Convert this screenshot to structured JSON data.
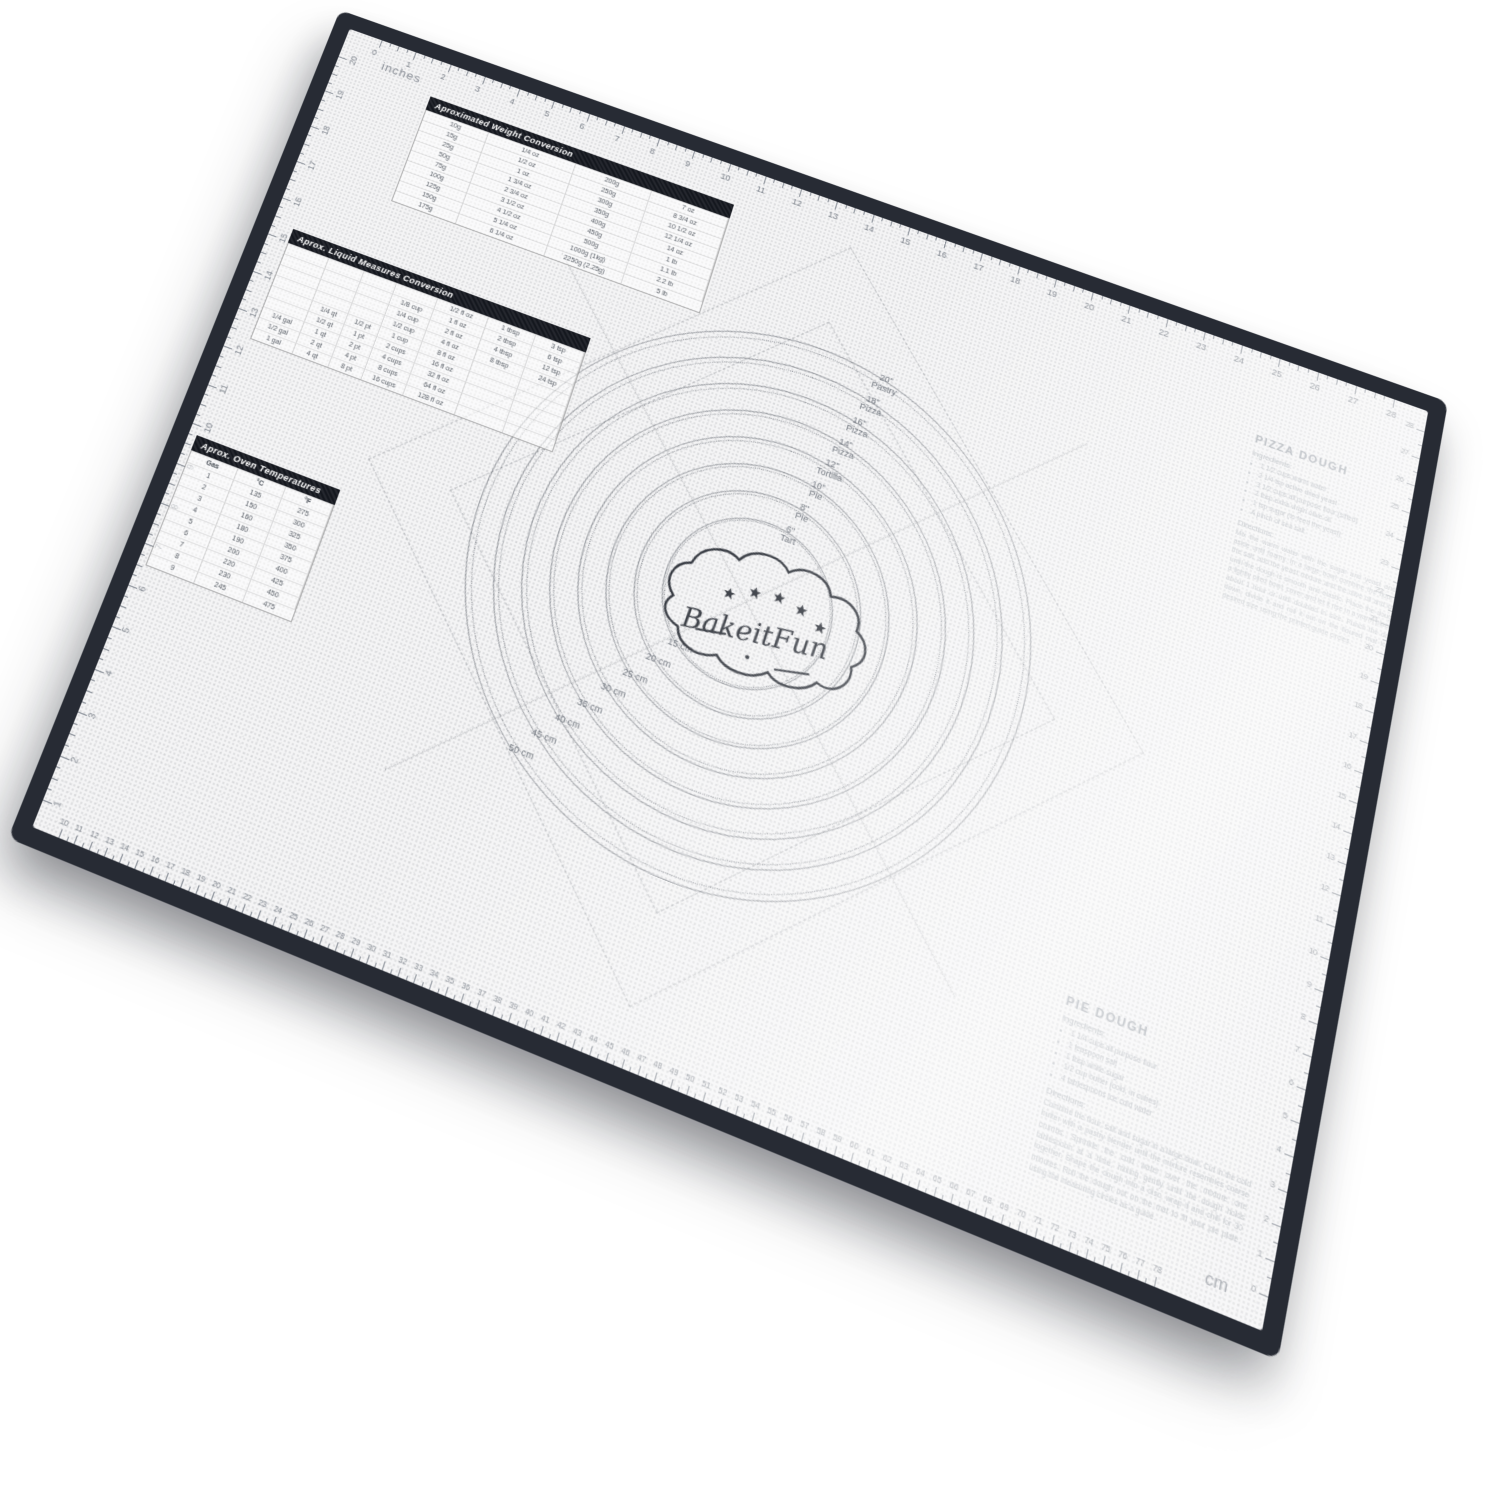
{
  "mat": {
    "brand": "BakeitFun",
    "border_color": "#272b34",
    "surface_color": "#f4f4f5",
    "unit_label_top": "inches",
    "unit_label_bottom": "cm",
    "rulers": {
      "top_inches": {
        "start": 0,
        "end": 28
      },
      "left_inches": {
        "start": 20,
        "end": 1
      },
      "bottom_cm": {
        "start": 10,
        "end": 78
      },
      "right_cm": {
        "start": 0,
        "end": 28
      }
    },
    "center": {
      "cx": 575,
      "cy": 445
    },
    "inch_circles": [
      {
        "size": "20\"",
        "type": "Pastry",
        "radius": 270
      },
      {
        "size": "18\"",
        "type": "Pizza",
        "radius": 243
      },
      {
        "size": "16\"",
        "type": "Pizza",
        "radius": 216
      },
      {
        "size": "14\"",
        "type": "Pizza",
        "radius": 189
      },
      {
        "size": "12\"",
        "type": "Tortilla",
        "radius": 162
      },
      {
        "size": "10\"",
        "type": "Pie",
        "radius": 135
      },
      {
        "size": "8\"",
        "type": "Pie",
        "radius": 108
      },
      {
        "size": "6\"",
        "type": "Tart",
        "radius": 81
      }
    ],
    "cm_circles": [
      {
        "label": "50 cm",
        "radius": 264
      },
      {
        "label": "45 cm",
        "radius": 238
      },
      {
        "label": "40 cm",
        "radius": 211
      },
      {
        "label": "35 cm",
        "radius": 185
      },
      {
        "label": "30 cm",
        "radius": 158
      },
      {
        "label": "25 cm",
        "radius": 132
      },
      {
        "label": "20 cm",
        "radius": 105
      },
      {
        "label": "15 cm",
        "radius": 79
      }
    ],
    "weight_table": {
      "title": "Aproximated Weight Conversion",
      "rows": [
        [
          "10g",
          "1/4 oz",
          "200g",
          "7 oz"
        ],
        [
          "15g",
          "1/2 oz",
          "250g",
          "8 3/4 oz"
        ],
        [
          "25g",
          "1 oz",
          "300g",
          "10 1/2 oz"
        ],
        [
          "50g",
          "1 3/4 oz",
          "350g",
          "12 1/4 oz"
        ],
        [
          "75g",
          "2 3/4 oz",
          "400g",
          "14 oz"
        ],
        [
          "100g",
          "3 1/2 oz",
          "450g",
          "1 lb"
        ],
        [
          "125g",
          "4 1/2 oz",
          "500g",
          "1.1 lb"
        ],
        [
          "150g",
          "5 1/4 oz",
          "1000g (1kg)",
          "2.2 lb"
        ],
        [
          "175g",
          "6 1/4 oz",
          "2250g (2.25g)",
          "5 lb"
        ]
      ]
    },
    "liquid_table": {
      "title": "Aprox. Liquid Measures Conversion",
      "rows": [
        [
          "",
          "",
          "",
          "",
          "1/2 fl oz",
          "1 tbsp",
          "3 tsp"
        ],
        [
          "",
          "",
          "",
          "1/8 cup",
          "1 fl oz",
          "2 tbsp",
          "6 tsp"
        ],
        [
          "",
          "",
          "",
          "1/4 cup",
          "2 fl oz",
          "4 tbsp",
          "12 tsp"
        ],
        [
          "",
          "",
          "",
          "1/2 cup",
          "4 fl oz",
          "8 tbsp",
          "24 tsp"
        ],
        [
          "",
          "1/4 qt",
          "1/2 pt",
          "1 cup",
          "8 fl oz",
          "",
          ""
        ],
        [
          "",
          "1/2 qt",
          "1 pt",
          "2 cups",
          "16 fl oz",
          "",
          ""
        ],
        [
          "1/4 gal",
          "1 qt",
          "2 pt",
          "4 cups",
          "32 fl oz",
          "",
          ""
        ],
        [
          "1/2 gal",
          "2 qt",
          "4 pt",
          "8 cups",
          "64 fl oz",
          "",
          ""
        ],
        [
          "1 gal",
          "4 qt",
          "8 pt",
          "16 cups",
          "128 fl oz",
          "",
          ""
        ]
      ]
    },
    "oven_table": {
      "title": "Aprox. Oven Temperatures",
      "headers": [
        "Gas",
        "°C",
        "°F"
      ],
      "rows": [
        [
          "1",
          "135",
          "275"
        ],
        [
          "2",
          "150",
          "300"
        ],
        [
          "3",
          "160",
          "325"
        ],
        [
          "4",
          "180",
          "350"
        ],
        [
          "5",
          "190",
          "375"
        ],
        [
          "6",
          "200",
          "400"
        ],
        [
          "7",
          "220",
          "425"
        ],
        [
          "8",
          "230",
          "450"
        ],
        [
          "9",
          "245",
          "475"
        ]
      ]
    },
    "recipes": {
      "pizza": {
        "title": "PIZZA DOUGH",
        "ingredients_label": "Ingredients:",
        "ingredients": [
          "1 1/2 cups warm water",
          "2 1/4 tsp active dried yeast",
          "3 1/2 cups all purpose flour (sifted)",
          "2 tbsp extra virgin olive oil",
          "1 tsp sugar (to feed the yeast)",
          "A pinch of sea salt"
        ],
        "directions_label": "Directions:",
        "directions": "Mix the warm water with the sugar and yeast and set aside until foamy. In a large bowl combine the flour and the salt, add the yeast mixture and the olive oil and knead until the dough is smooth and elastic. Place the dough in a lightly oiled bowl, cover and let it rise in a warm place for about 1 hour or until doubled in size. Punch the dough down, divide it and roll it out on the floured mat to the desired size using the printed guide circles."
      },
      "pie": {
        "title": "PIE DOUGH",
        "ingredients_label": "Ingredients:",
        "ingredients": [
          "1 1/4 cups all purpose flour",
          "1 teaspoon salt",
          "1 tbsp white sugar",
          "1/2 cup butter (cold, in cubes)",
          "4 tablespoons ice cold water"
        ],
        "directions_label": "Directions:",
        "directions": "Combine the flour, salt and sugar in a large bowl. Cut in the cold butter with a pastry blender until the mixture resembles coarse crumbs. Sprinkle the cold water over the mixture one tablespoon at a time, mixing gently until the dough holds together. Shape the dough into a disc, wrap it and chill for 30 minutes. Roll the dough out on the mat to fit your pie plate, using the measuring circles as a guide."
      }
    }
  }
}
